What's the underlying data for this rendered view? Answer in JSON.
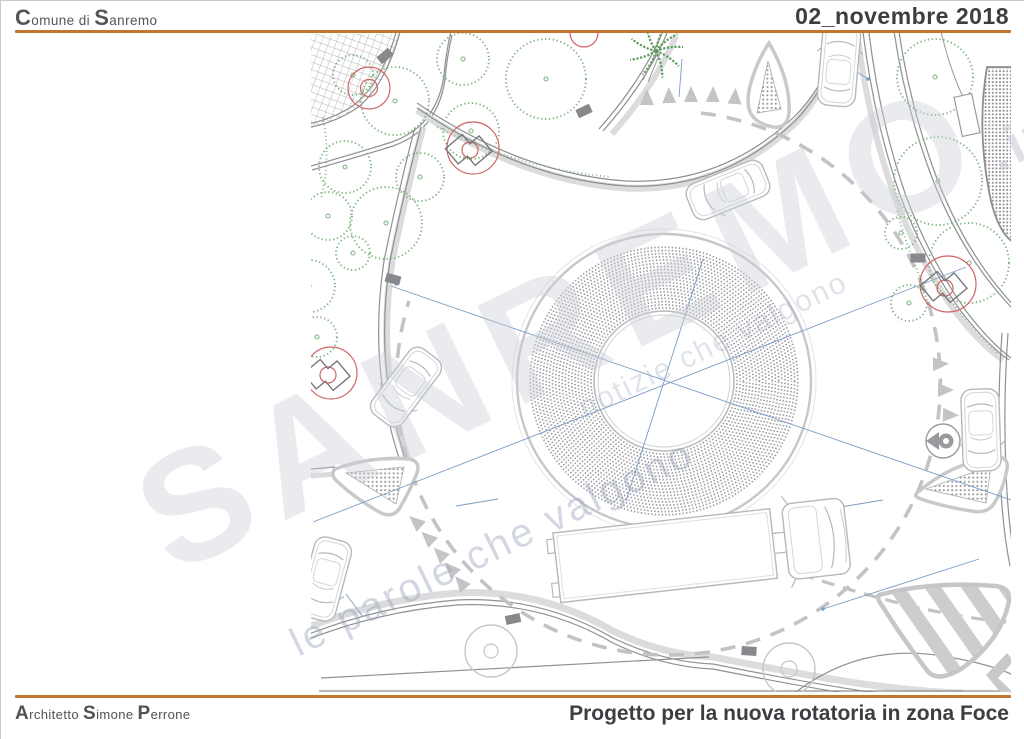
{
  "header": {
    "brand": {
      "c1": "C",
      "t1": "omune di ",
      "c2": "S",
      "t2": "anremo"
    },
    "date": "02_novembre 2018"
  },
  "footer": {
    "author": {
      "c1": "A",
      "t1": "rchitetto ",
      "c2": "S",
      "t2": "imone ",
      "c3": "P",
      "t3": "errone"
    },
    "title": "Progetto per la nuova rotatoria in zona Foce"
  },
  "watermark": {
    "brand": "SANREMO",
    "tld": ".it",
    "slogan": "le parole che valgono",
    "slogan_alt": "notizie che valgono"
  },
  "colors": {
    "accent_orange": "#c0762c",
    "tree_green": "#7fb57f",
    "marker_red": "#cf6464",
    "guide_blue": "#7b9cc4",
    "road_gray": "#8f9092"
  }
}
